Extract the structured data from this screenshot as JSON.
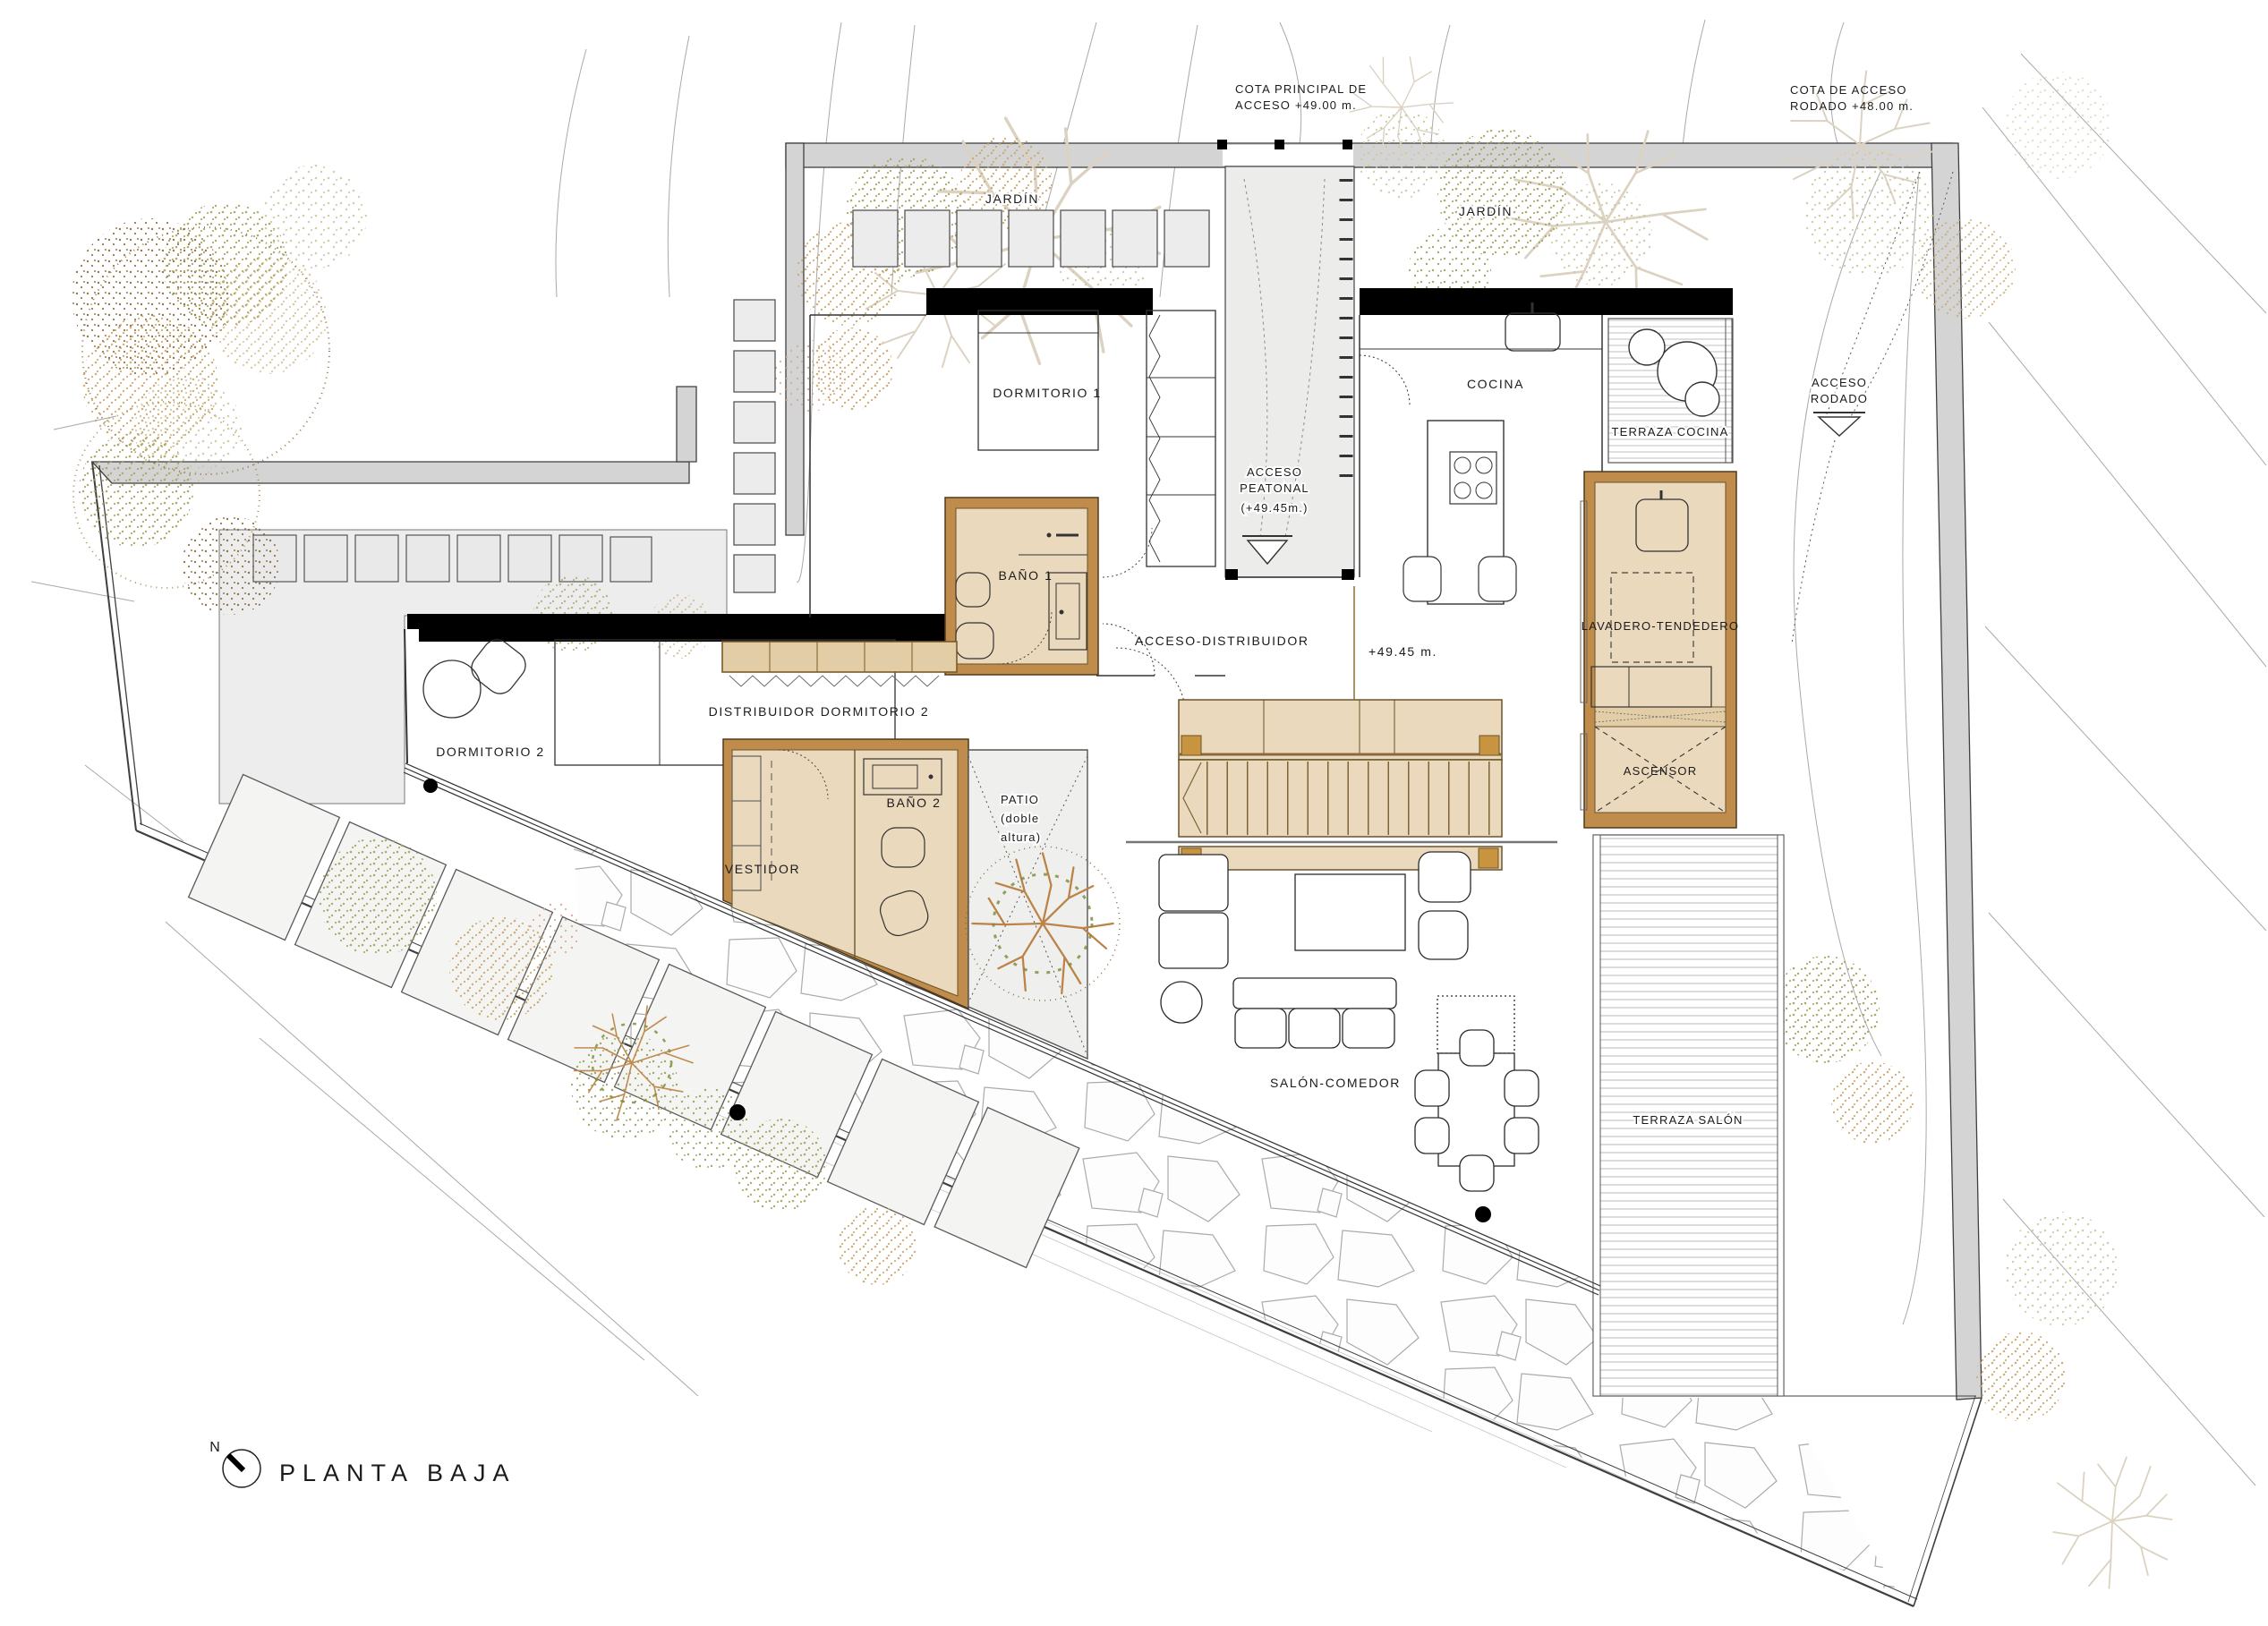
{
  "plan": {
    "title": "PLANTA  BAJA",
    "north": "N"
  },
  "labels": {
    "cota_principal_1": "COTA  PRINCIPAL  DE",
    "cota_principal_2": "ACCESO  +49.00  m.",
    "cota_rodado_1": "COTA  DE  ACCESO",
    "cota_rodado_2": "RODADO  +48.00  m.",
    "jardin_left": "JARDÍN",
    "jardin_right": "JARDÍN",
    "dormitorio_1": "DORMITORIO  1",
    "cocina": "COCINA",
    "terraza_cocina": "TERRAZA  COCINA",
    "acceso_rodado_1": "ACCESO",
    "acceso_rodado_2": "RODADO",
    "acceso_peatonal_1": "ACCESO",
    "acceso_peatonal_2": "PEATONAL",
    "acceso_peatonal_3": "(+49.45m.)",
    "bano_1": "BAÑO  1",
    "acceso_distribuidor": "ACCESO-DISTRIBUIDOR",
    "cota_4945": "+49.45  m.",
    "lavadero": "LAVADERO-TENDEDERO",
    "ascensor": "ASCENSOR",
    "dormitorio_2": "DORMITORIO  2",
    "distribuidor_dormitorio_2": "DISTRIBUIDOR  DORMITORIO  2",
    "bano_2": "BAÑO  2",
    "vestidor": "VESTIDOR",
    "patio_1": "PATIO",
    "patio_2": "(doble",
    "patio_3": "altura)",
    "salon_comedor": "SALÓN-COMEDOR",
    "terraza_salon": "TERRAZA  SALÓN"
  },
  "colors": {
    "wood_wall": "#bf8c4c",
    "wood_fill": "#ead9bc",
    "wood_accent": "#c89440",
    "site_wall": "#d4d4d4",
    "floor_gray": "#ededed",
    "structure_black": "#000000",
    "contour": "#a0a0a0",
    "veg_olive": "#a8a25e",
    "veg_tan": "#c9a96e",
    "veg_brown": "#8a6a3a",
    "veg_pale": "#cdc9a2",
    "veg_green": "#9aa05a",
    "veg_salmon": "#d8a98c",
    "tree_skeleton": "#dcd2c2",
    "tree_sienna": "#bb8347"
  }
}
